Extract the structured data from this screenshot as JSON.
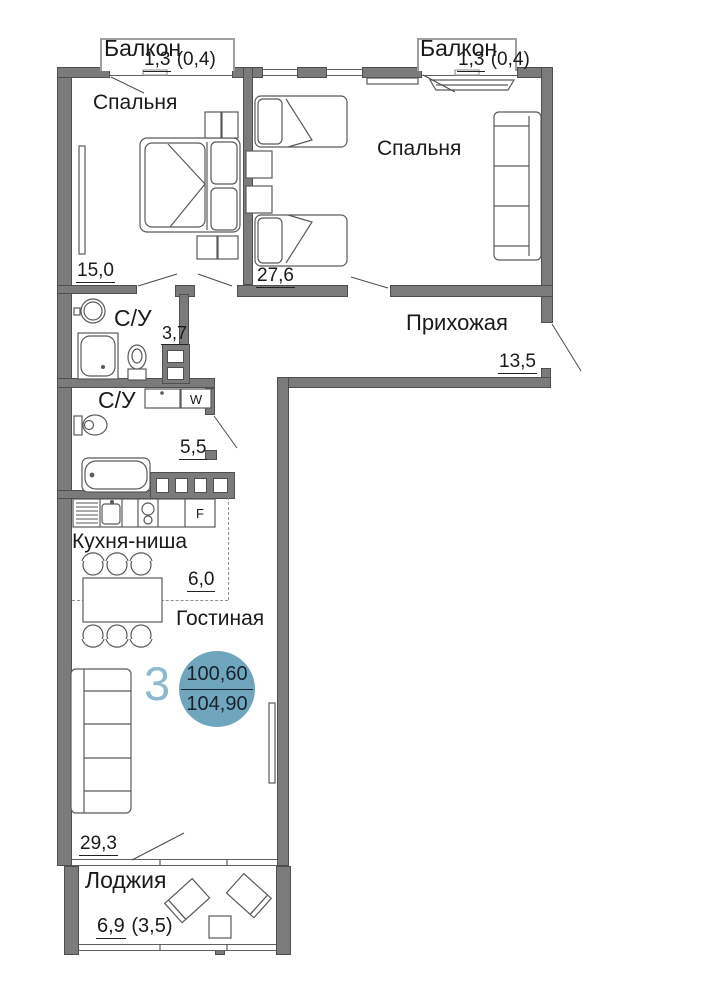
{
  "floorplan": {
    "badge": {
      "rooms_count": "3",
      "area_total": "100,60",
      "area_full": "104,90"
    },
    "rooms": {
      "balcony_left": {
        "name": "Балкон",
        "area": "1,3",
        "area_note": "(0,4)"
      },
      "balcony_right": {
        "name": "Балкон",
        "area": "1,3",
        "area_note": "(0,4)"
      },
      "bedroom_left": {
        "name": "Спальня",
        "area": "15,0"
      },
      "bedroom_right": {
        "name": "Спальня",
        "area": "27,6"
      },
      "hallway": {
        "name": "Прихожая",
        "area": "13,5"
      },
      "bathroom_upper": {
        "name": "С/У",
        "area": "3,7"
      },
      "bathroom_lower": {
        "name": "С/У",
        "area": "5,5"
      },
      "kitchen": {
        "name": "Кухня-ниша",
        "area": "6,0"
      },
      "living": {
        "name": "Гостиная",
        "area": "29,3"
      },
      "loggia": {
        "name": "Лоджия",
        "area": "6,9",
        "area_note": "(3,5)"
      }
    },
    "appliances": {
      "washer": "W",
      "fridge": "F"
    },
    "colors": {
      "wall": "#7b7b7b",
      "badge_circle": "#6fa5bd",
      "badge_number": "#8db8cd",
      "badge_text": "#17222c"
    }
  }
}
